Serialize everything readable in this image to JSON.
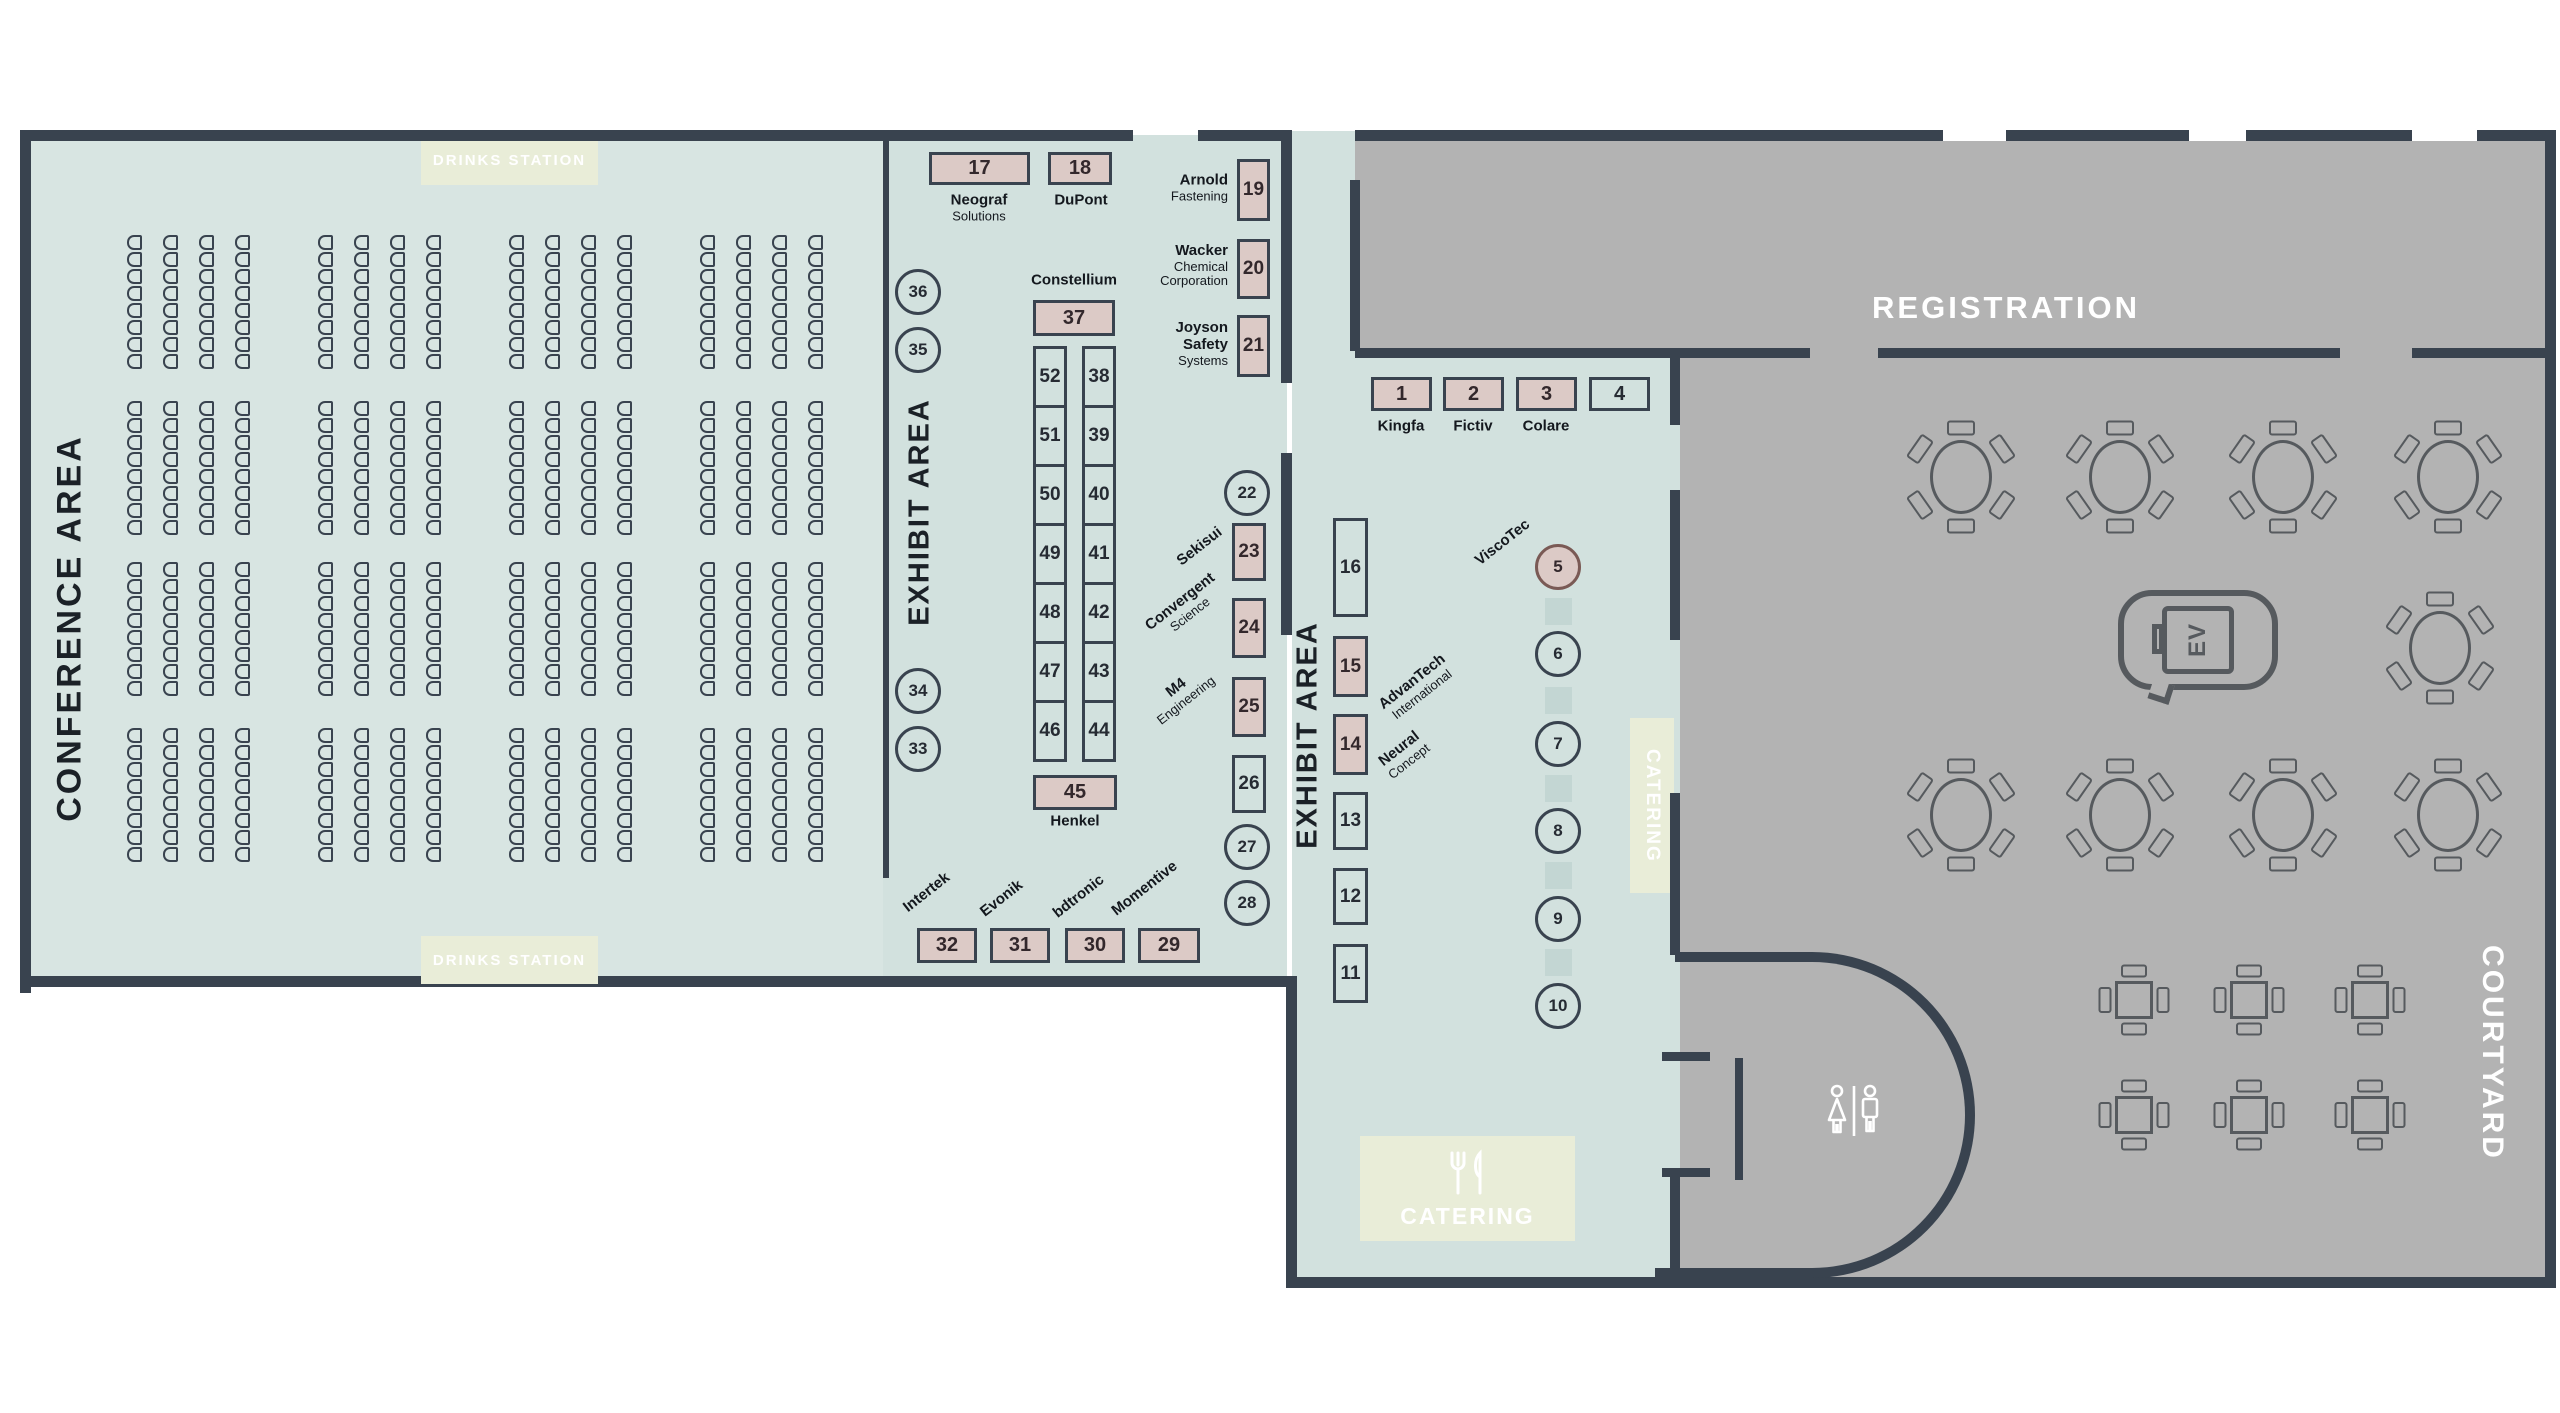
{
  "colors": {
    "floor_mint": "#d2e1de",
    "floor_mint_light": "#d8e5e2",
    "floor_gray": "#b3b3b3",
    "wall": "#39434f",
    "booth_occupied_fill": "#dccac6",
    "accent_green": "#e9edd8",
    "table_line": "#565a5e",
    "ink": "#1b2127"
  },
  "labels": {
    "conference_area": "CONFERENCE AREA",
    "exhibit_area_1": "EXHIBIT AREA",
    "exhibit_area_2": "EXHIBIT AREA",
    "registration": "REGISTRATION",
    "courtyard": "COURTYARD",
    "drinks_station_top": "DRINKS STATION",
    "drinks_station_bottom": "DRINKS STATION",
    "catering_main": "CATERING",
    "catering_side": "CATERING",
    "ev_marking": "EV"
  },
  "booths": [
    {
      "n": "17",
      "x": 929,
      "y": 152,
      "w": 101,
      "h": 33,
      "occ": true,
      "fs": 20
    },
    {
      "n": "18",
      "x": 1048,
      "y": 152,
      "w": 64,
      "h": 33,
      "occ": true,
      "fs": 20
    },
    {
      "n": "19",
      "x": 1237,
      "y": 159,
      "w": 33,
      "h": 62,
      "occ": true,
      "fs": 19
    },
    {
      "n": "20",
      "x": 1237,
      "y": 239,
      "w": 33,
      "h": 60,
      "occ": true,
      "fs": 19
    },
    {
      "n": "21",
      "x": 1237,
      "y": 315,
      "w": 33,
      "h": 62,
      "occ": true,
      "fs": 19
    },
    {
      "n": "37",
      "x": 1033,
      "y": 300,
      "w": 82,
      "h": 36,
      "occ": true,
      "fs": 20
    },
    {
      "n": "52",
      "x": 1033,
      "y": 346,
      "w": 34,
      "h": 62,
      "occ": false,
      "fs": 19
    },
    {
      "n": "51",
      "x": 1033,
      "y": 405,
      "w": 34,
      "h": 62,
      "occ": false,
      "fs": 19
    },
    {
      "n": "50",
      "x": 1033,
      "y": 464,
      "w": 34,
      "h": 62,
      "occ": false,
      "fs": 19
    },
    {
      "n": "49",
      "x": 1033,
      "y": 523,
      "w": 34,
      "h": 62,
      "occ": false,
      "fs": 19
    },
    {
      "n": "48",
      "x": 1033,
      "y": 582,
      "w": 34,
      "h": 62,
      "occ": false,
      "fs": 19
    },
    {
      "n": "47",
      "x": 1033,
      "y": 641,
      "w": 34,
      "h": 62,
      "occ": false,
      "fs": 19
    },
    {
      "n": "46",
      "x": 1033,
      "y": 700,
      "w": 34,
      "h": 62,
      "occ": false,
      "fs": 19
    },
    {
      "n": "38",
      "x": 1082,
      "y": 346,
      "w": 34,
      "h": 62,
      "occ": false,
      "fs": 19
    },
    {
      "n": "39",
      "x": 1082,
      "y": 405,
      "w": 34,
      "h": 62,
      "occ": false,
      "fs": 19
    },
    {
      "n": "40",
      "x": 1082,
      "y": 464,
      "w": 34,
      "h": 62,
      "occ": false,
      "fs": 19
    },
    {
      "n": "41",
      "x": 1082,
      "y": 523,
      "w": 34,
      "h": 62,
      "occ": false,
      "fs": 19
    },
    {
      "n": "42",
      "x": 1082,
      "y": 582,
      "w": 34,
      "h": 62,
      "occ": false,
      "fs": 19
    },
    {
      "n": "43",
      "x": 1082,
      "y": 641,
      "w": 34,
      "h": 62,
      "occ": false,
      "fs": 19
    },
    {
      "n": "44",
      "x": 1082,
      "y": 700,
      "w": 34,
      "h": 62,
      "occ": false,
      "fs": 19
    },
    {
      "n": "45",
      "x": 1033,
      "y": 775,
      "w": 84,
      "h": 35,
      "occ": true,
      "fs": 20
    },
    {
      "n": "23",
      "x": 1232,
      "y": 523,
      "w": 34,
      "h": 58,
      "occ": true,
      "fs": 19
    },
    {
      "n": "24",
      "x": 1232,
      "y": 598,
      "w": 34,
      "h": 60,
      "occ": true,
      "fs": 19
    },
    {
      "n": "25",
      "x": 1232,
      "y": 677,
      "w": 34,
      "h": 60,
      "occ": true,
      "fs": 19
    },
    {
      "n": "26",
      "x": 1232,
      "y": 755,
      "w": 34,
      "h": 58,
      "occ": false,
      "fs": 19
    },
    {
      "n": "32",
      "x": 917,
      "y": 928,
      "w": 60,
      "h": 35,
      "occ": true,
      "fs": 20
    },
    {
      "n": "31",
      "x": 990,
      "y": 928,
      "w": 60,
      "h": 35,
      "occ": true,
      "fs": 20
    },
    {
      "n": "30",
      "x": 1065,
      "y": 928,
      "w": 60,
      "h": 35,
      "occ": true,
      "fs": 20
    },
    {
      "n": "29",
      "x": 1138,
      "y": 928,
      "w": 62,
      "h": 35,
      "occ": true,
      "fs": 20
    },
    {
      "n": "1",
      "x": 1371,
      "y": 377,
      "w": 61,
      "h": 34,
      "occ": true,
      "fs": 20
    },
    {
      "n": "2",
      "x": 1443,
      "y": 377,
      "w": 61,
      "h": 34,
      "occ": true,
      "fs": 20
    },
    {
      "n": "3",
      "x": 1516,
      "y": 377,
      "w": 61,
      "h": 34,
      "occ": true,
      "fs": 20
    },
    {
      "n": "4",
      "x": 1589,
      "y": 377,
      "w": 61,
      "h": 34,
      "occ": false,
      "fs": 20
    },
    {
      "n": "16",
      "x": 1333,
      "y": 518,
      "w": 35,
      "h": 99,
      "occ": false,
      "fs": 19
    },
    {
      "n": "15",
      "x": 1333,
      "y": 636,
      "w": 35,
      "h": 61,
      "occ": true,
      "fs": 19
    },
    {
      "n": "14",
      "x": 1333,
      "y": 714,
      "w": 35,
      "h": 61,
      "occ": true,
      "fs": 19
    },
    {
      "n": "13",
      "x": 1333,
      "y": 792,
      "w": 35,
      "h": 58,
      "occ": false,
      "fs": 19
    },
    {
      "n": "12",
      "x": 1333,
      "y": 868,
      "w": 35,
      "h": 57,
      "occ": false,
      "fs": 19
    },
    {
      "n": "11",
      "x": 1333,
      "y": 944,
      "w": 35,
      "h": 59,
      "occ": false,
      "fs": 19
    }
  ],
  "circle_booths": [
    {
      "n": "36",
      "cx": 918,
      "cy": 292,
      "occ": false
    },
    {
      "n": "35",
      "cx": 918,
      "cy": 350,
      "occ": false
    },
    {
      "n": "34",
      "cx": 918,
      "cy": 691,
      "occ": false
    },
    {
      "n": "33",
      "cx": 918,
      "cy": 749,
      "occ": false
    },
    {
      "n": "22",
      "cx": 1247,
      "cy": 493,
      "occ": false
    },
    {
      "n": "27",
      "cx": 1247,
      "cy": 847,
      "occ": false
    },
    {
      "n": "28",
      "cx": 1247,
      "cy": 903,
      "occ": false
    },
    {
      "n": "5",
      "cx": 1558,
      "cy": 567,
      "occ": true
    },
    {
      "n": "6",
      "cx": 1558,
      "cy": 654,
      "occ": false
    },
    {
      "n": "7",
      "cx": 1558,
      "cy": 744,
      "occ": false
    },
    {
      "n": "8",
      "cx": 1558,
      "cy": 831,
      "occ": false
    },
    {
      "n": "9",
      "cx": 1558,
      "cy": 919,
      "occ": false
    },
    {
      "n": "10",
      "cx": 1558,
      "cy": 1006,
      "occ": false
    }
  ],
  "pillars": [
    [
      1558,
      611
    ],
    [
      1558,
      700
    ],
    [
      1558,
      788
    ],
    [
      1558,
      875
    ],
    [
      1558,
      962
    ]
  ],
  "exhibitors": [
    {
      "id": "neograf-solutions",
      "x": 979,
      "y": 208,
      "align": "center",
      "rot": 0,
      "lines": [
        [
          "Neograf",
          1
        ],
        [
          "Solutions",
          0
        ]
      ]
    },
    {
      "id": "dupont",
      "x": 1081,
      "y": 201,
      "align": "center",
      "rot": 0,
      "lines": [
        [
          "DuPont",
          1
        ]
      ]
    },
    {
      "id": "constellium",
      "x": 1074,
      "y": 281,
      "align": "center",
      "rot": 0,
      "lines": [
        [
          "Constellium",
          1
        ]
      ]
    },
    {
      "id": "henkel",
      "x": 1075,
      "y": 822,
      "align": "center",
      "rot": 0,
      "lines": [
        [
          "Henkel",
          1
        ]
      ]
    },
    {
      "id": "arnold-fastening",
      "x": 1228,
      "y": 188,
      "align": "right",
      "rot": 0,
      "lines": [
        [
          "Arnold",
          1
        ],
        [
          "Fastening",
          0
        ]
      ]
    },
    {
      "id": "wacker-chemical",
      "x": 1228,
      "y": 266,
      "align": "right",
      "rot": 0,
      "lines": [
        [
          "Wacker",
          1
        ],
        [
          "Chemical",
          0
        ],
        [
          "Corporation",
          0
        ]
      ]
    },
    {
      "id": "joyson-safety",
      "x": 1228,
      "y": 344,
      "align": "right",
      "rot": 0,
      "lines": [
        [
          "Joyson",
          1
        ],
        [
          "Safety",
          1
        ],
        [
          "Systems",
          0
        ]
      ]
    },
    {
      "id": "kingfa",
      "x": 1401,
      "y": 427,
      "align": "center",
      "rot": 0,
      "lines": [
        [
          "Kingfa",
          1
        ]
      ]
    },
    {
      "id": "fictiv",
      "x": 1473,
      "y": 427,
      "align": "center",
      "rot": 0,
      "lines": [
        [
          "Fictiv",
          1
        ]
      ]
    },
    {
      "id": "colare",
      "x": 1546,
      "y": 427,
      "align": "center",
      "rot": 0,
      "lines": [
        [
          "Colare",
          1
        ]
      ]
    },
    {
      "id": "sekisui",
      "x": 1200,
      "y": 547,
      "align": "center",
      "rot": -38,
      "lines": [
        [
          "Sekisui",
          1
        ]
      ]
    },
    {
      "id": "convergent-science",
      "x": 1185,
      "y": 608,
      "align": "center",
      "rot": -38,
      "lines": [
        [
          "Convergent",
          1
        ],
        [
          "Science",
          0
        ]
      ]
    },
    {
      "id": "m4-engineering",
      "x": 1181,
      "y": 694,
      "align": "center",
      "rot": -38,
      "lines": [
        [
          "M4",
          1
        ],
        [
          "Engineering",
          0
        ]
      ]
    },
    {
      "id": "intertek",
      "x": 927,
      "y": 893,
      "align": "center",
      "rot": -38,
      "lines": [
        [
          "Intertek",
          1
        ]
      ]
    },
    {
      "id": "evonik",
      "x": 1002,
      "y": 899,
      "align": "center",
      "rot": -38,
      "lines": [
        [
          "Evonik",
          1
        ]
      ]
    },
    {
      "id": "bdtronic",
      "x": 1079,
      "y": 897,
      "align": "center",
      "rot": -38,
      "lines": [
        [
          "bdtronic",
          1
        ]
      ]
    },
    {
      "id": "momentive",
      "x": 1145,
      "y": 889,
      "align": "center",
      "rot": -38,
      "lines": [
        [
          "Momentive",
          1
        ]
      ]
    },
    {
      "id": "viscotec",
      "x": 1503,
      "y": 543,
      "align": "center",
      "rot": -38,
      "lines": [
        [
          "ViscoTec",
          1
        ]
      ]
    },
    {
      "id": "advantech-international",
      "x": 1417,
      "y": 688,
      "align": "center",
      "rot": -38,
      "lines": [
        [
          "AdvanTech",
          1
        ],
        [
          "International",
          0
        ]
      ]
    },
    {
      "id": "neural-concept",
      "x": 1404,
      "y": 755,
      "align": "center",
      "rot": -38,
      "lines": [
        [
          "Neural",
          1
        ],
        [
          "Concept",
          0
        ]
      ]
    }
  ],
  "conference_seating": {
    "band_tops": [
      235,
      401,
      562,
      728
    ],
    "group_lefts": [
      127,
      318,
      509,
      700
    ],
    "cols_per_group": 4,
    "col_spacing": 36,
    "chairs_per_col": 8,
    "chair_w": 15,
    "chair_h": 15,
    "chair_gap": 2
  },
  "courtyard_furniture": {
    "round_tables": [
      [
        1961,
        477
      ],
      [
        2120,
        477
      ],
      [
        2283,
        477
      ],
      [
        2448,
        477
      ],
      [
        2440,
        648
      ],
      [
        1961,
        815
      ],
      [
        2120,
        815
      ],
      [
        2283,
        815
      ],
      [
        2448,
        815
      ]
    ],
    "square_tables": [
      [
        2134,
        1000
      ],
      [
        2249,
        1000
      ],
      [
        2370,
        1000
      ],
      [
        2134,
        1115
      ],
      [
        2249,
        1115
      ],
      [
        2370,
        1115
      ]
    ]
  }
}
